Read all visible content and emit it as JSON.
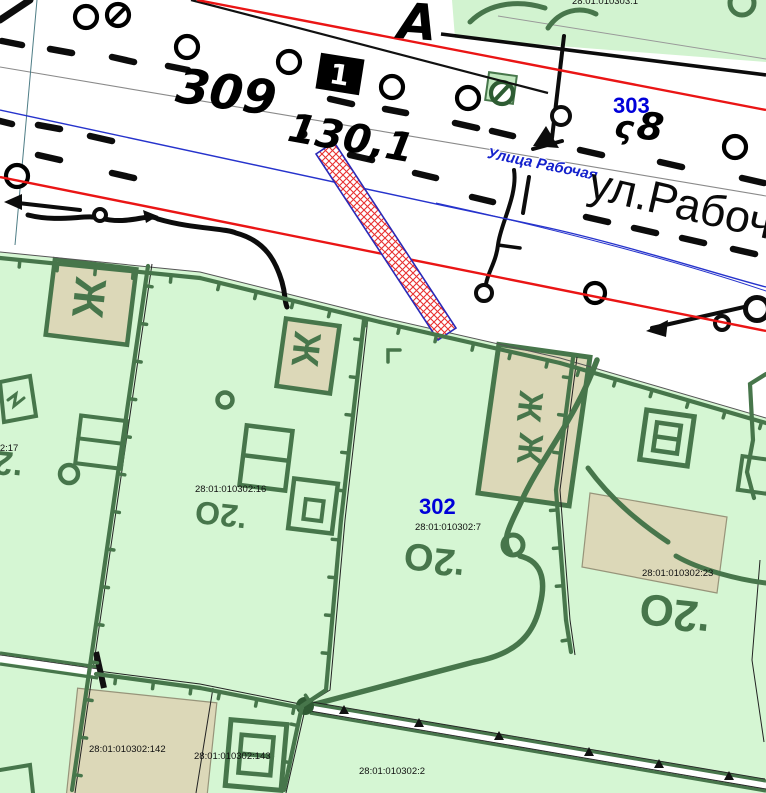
{
  "title": "Cadastral map fragment",
  "colors": {
    "background": "#ffffff",
    "parcel_green": "#d5f6d3",
    "topo_dark_green": "#47764b",
    "building_beige": "#dcd8b8",
    "red_line": "#ea1515",
    "blue_line": "#2633cc",
    "quarter_label_blue": "#0000d9",
    "selected_parcel_hatch": "#e83030",
    "selected_parcel_border": "#2a2ab8"
  },
  "quarters": [
    {
      "number": "303"
    },
    {
      "number": "302"
    }
  ],
  "streets": [
    {
      "name": "Улица Рабочая"
    },
    {
      "name": "ул.Рабочая"
    }
  ],
  "parcel_numbers": [
    "28:01:010303:1",
    "28:01:010302:17",
    "28:01:010302:16",
    "28:01:010302:7",
    "28:01:010302:23",
    "28:01:010302:142",
    "28:01:010302:143",
    "28:01:010302:2"
  ],
  "topo_marks": [
    "309",
    "130,1",
    "А",
    "ς",
    "8",
    "1",
    "О2.",
    "Ж"
  ],
  "labels": [
    {
      "name": "parcel-label-010303-1",
      "text": "28:01:010303:1",
      "x": 572,
      "y": -3,
      "size": 9.5,
      "color": "#111111",
      "rot": 0
    },
    {
      "name": "quarter-label-303",
      "text": "303",
      "x": 613,
      "y": 95,
      "size": 22,
      "color": "#0000d9",
      "rot": 0,
      "weight": "bold"
    },
    {
      "name": "street-label-ulitsa-rabochaya",
      "text": "Улица Рабочая",
      "x": 489,
      "y": 146,
      "size": 15,
      "color": "#1522cc",
      "rot": 11.5,
      "weight": "bold",
      "style": "italic",
      "halo": true
    },
    {
      "name": "street-label-ul-rabochaya",
      "text": "ул.Рабочая",
      "x": 595,
      "y": 160,
      "size": 45,
      "color": "#0a0a0a",
      "rot": 13
    },
    {
      "name": "topo-number-309",
      "text": "309",
      "x": 180,
      "y": 62,
      "size": 48,
      "color": "#000000",
      "rot": 8,
      "weight": "bold",
      "style": "italic",
      "hand": true
    },
    {
      "name": "topo-number-130-1",
      "text": "130,1",
      "x": 292,
      "y": 108,
      "size": 40,
      "color": "#000000",
      "rot": 10,
      "weight": "bold",
      "style": "italic",
      "hand": true
    },
    {
      "name": "topo-letter-a",
      "text": "А",
      "x": 400,
      "y": -4,
      "size": 50,
      "color": "#000000",
      "rot": 4,
      "weight": "bold",
      "style": "italic",
      "hand": true
    },
    {
      "name": "topo-glyph-s",
      "text": "ς",
      "x": 617,
      "y": 110,
      "size": 32,
      "color": "#000000",
      "rot": 8,
      "weight": "bold",
      "style": "italic",
      "hand": true
    },
    {
      "name": "topo-number-8",
      "text": "8",
      "x": 640,
      "y": 106,
      "size": 38,
      "color": "#000000",
      "rot": 8,
      "weight": "bold",
      "style": "italic",
      "hand": true
    },
    {
      "name": "topo-number-1",
      "text": "1",
      "x": 332,
      "y": 60,
      "size": 28,
      "color": "#ffffff",
      "rot": 9,
      "weight": "bold",
      "hand": true
    },
    {
      "name": "quarter-label-302",
      "text": "302",
      "x": 419,
      "y": 496,
      "size": 22,
      "color": "#0000d9",
      "rot": 0,
      "weight": "bold"
    },
    {
      "name": "parcel-label-010302-7",
      "text": "28:01:010302:7",
      "x": 415,
      "y": 523,
      "size": 9.5,
      "color": "#111111",
      "rot": 0
    },
    {
      "name": "parcel-label-010302-17",
      "text": "28:01:010302:17",
      "x": -53,
      "y": 444,
      "size": 9.5,
      "color": "#111111",
      "rot": 0
    },
    {
      "name": "parcel-label-010302-16",
      "text": "28:01:010302:16",
      "x": 195,
      "y": 485,
      "size": 9.5,
      "color": "#111111",
      "rot": 0
    },
    {
      "name": "parcel-label-010302-23",
      "text": "28:01:010302:23",
      "x": 642,
      "y": 569,
      "size": 9.5,
      "color": "#111111",
      "rot": 0
    },
    {
      "name": "parcel-label-010302-142",
      "text": "28:01:010302:142",
      "x": 89,
      "y": 745,
      "size": 9.5,
      "color": "#111111",
      "rot": 0
    },
    {
      "name": "parcel-label-010302-143",
      "text": "28:01:010302:143",
      "x": 194,
      "y": 752,
      "size": 9.5,
      "color": "#111111",
      "rot": 0
    },
    {
      "name": "parcel-label-010302-2",
      "text": "28:01:010302:2",
      "x": 359,
      "y": 767,
      "size": 9.5,
      "color": "#111111",
      "rot": 0
    },
    {
      "name": "vegetation-mark-o2-1",
      "text": "О2.",
      "x": -30,
      "y": 442,
      "size": 34,
      "color": "#47764b",
      "rot": 6,
      "weight": "bold",
      "flip": true
    },
    {
      "name": "vegetation-mark-o2-2",
      "text": "О2.",
      "x": 197,
      "y": 496,
      "size": 32,
      "color": "#47764b",
      "rot": 6,
      "weight": "bold",
      "flip": true
    },
    {
      "name": "vegetation-mark-o2-3",
      "text": "О2.",
      "x": 406,
      "y": 538,
      "size": 38,
      "color": "#47764b",
      "rot": 6,
      "weight": "bold",
      "flip": true
    },
    {
      "name": "vegetation-mark-o2-4",
      "text": "О2.",
      "x": 642,
      "y": 588,
      "size": 44,
      "color": "#47764b",
      "rot": 6,
      "weight": "bold",
      "flip": true
    },
    {
      "name": "residential-mark-zh-1",
      "text": "Ж",
      "x": 112,
      "y": 280,
      "size": 44,
      "color": "#47764b",
      "rot": 96,
      "weight": "bold"
    },
    {
      "name": "residential-mark-zh-2",
      "text": "Ж",
      "x": 326,
      "y": 334,
      "size": 38,
      "color": "#47764b",
      "rot": 96,
      "weight": "bold"
    },
    {
      "name": "residential-mark-zh-3",
      "text": "Ж",
      "x": 548,
      "y": 393,
      "size": 34,
      "color": "#47764b",
      "rot": 96,
      "weight": "bold"
    },
    {
      "name": "residential-mark-zh-4",
      "text": "Ж",
      "x": 548,
      "y": 435,
      "size": 34,
      "color": "#47764b",
      "rot": 96,
      "weight": "bold"
    }
  ]
}
